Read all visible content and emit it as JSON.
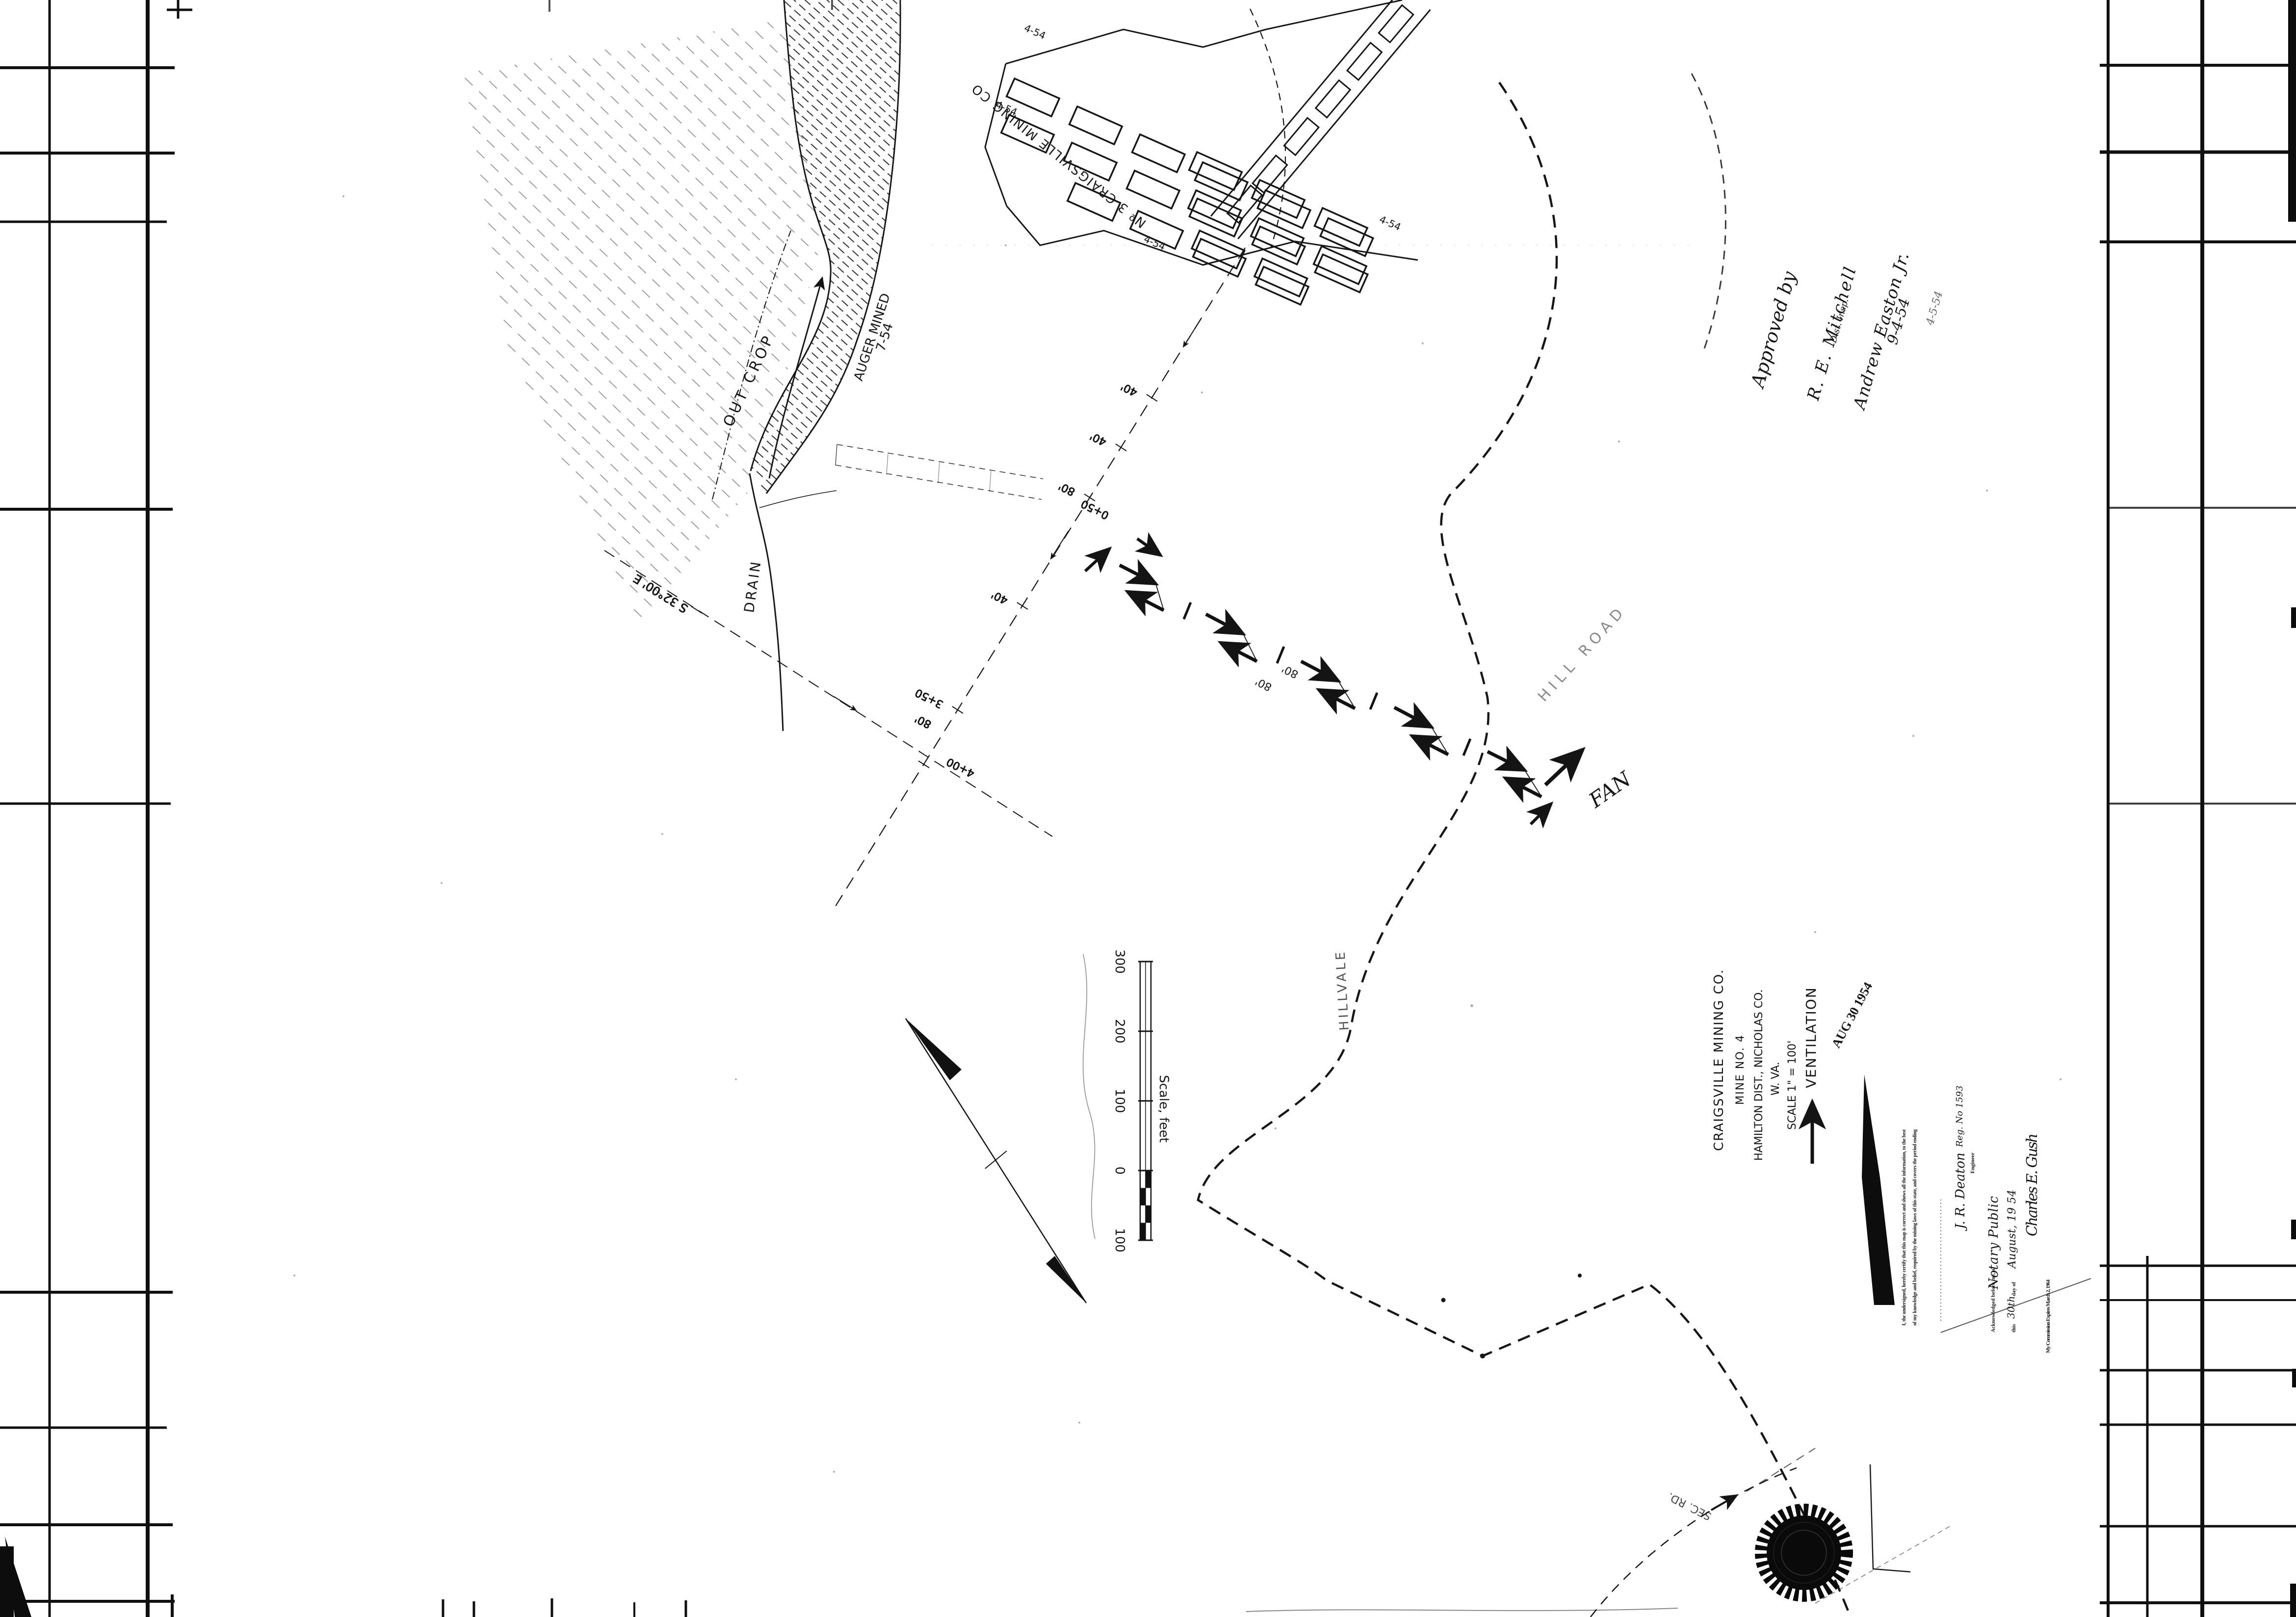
{
  "sheet": {
    "labels": {
      "workings_name": "Nº 3 CRAIGSVILLE MINING CO",
      "workings_dates": [
        "4-54",
        "4-54",
        "4-54",
        "4-54"
      ],
      "outcrop": "OUT CROP",
      "auger1": "AUGER MINED",
      "auger2": "7-54",
      "drain": "DRAIN",
      "bearing": "S 32°00' E",
      "fan": "FAN",
      "hill_road": "HILL ROAD",
      "hillvale": "HILLVALE",
      "sec_road": "SEC. RD.",
      "stations": [
        "40'",
        "40'",
        "80'",
        "0+50",
        "40'",
        "3+50",
        "80'",
        "4+00"
      ],
      "vent_dims": [
        "80'",
        "80'"
      ]
    },
    "scale_bar": {
      "title": "Scale, feet",
      "ticks": [
        "100",
        "0",
        "100",
        "200",
        "300"
      ]
    },
    "title_block": {
      "company": "CRAIGSVILLE MINING CO.",
      "mine": "MINE NO. 4",
      "district": "HAMILTON DIST., NICHOLAS CO.",
      "state": "W. VA.",
      "scale": "SCALE 1\" = 100'",
      "map_type": "VENTILATION",
      "date_stamp": "AUG 30 1954"
    },
    "approval": {
      "line1": "Approved by",
      "line2": "R. E. Mitchell",
      "line2b": "Dist. Insp.",
      "line3": "Andrew Easton Jr.",
      "line4": "9-4-54",
      "line5": "4-5-54"
    },
    "certificate": {
      "body1": "I, the undersigned, hereby certify that this map is correct and shows all the information, to the best",
      "body2": "of my knowledge and belief, required by the mining laws of this state, and covers the period ending",
      "engineer_sig": "J. R. Deaton",
      "engineer_reg": "Reg. No 1593",
      "engineer_title": "Engineer",
      "ack": "Acknowledged before me, a",
      "notary_role": "Notary Public",
      "this_word": "this",
      "day": "30th",
      "day_of": "day of",
      "month_year": "August, 19 54",
      "notary_sig": "Charles E. Gush",
      "commission": "My Commission Expires March 2, 1964"
    }
  }
}
